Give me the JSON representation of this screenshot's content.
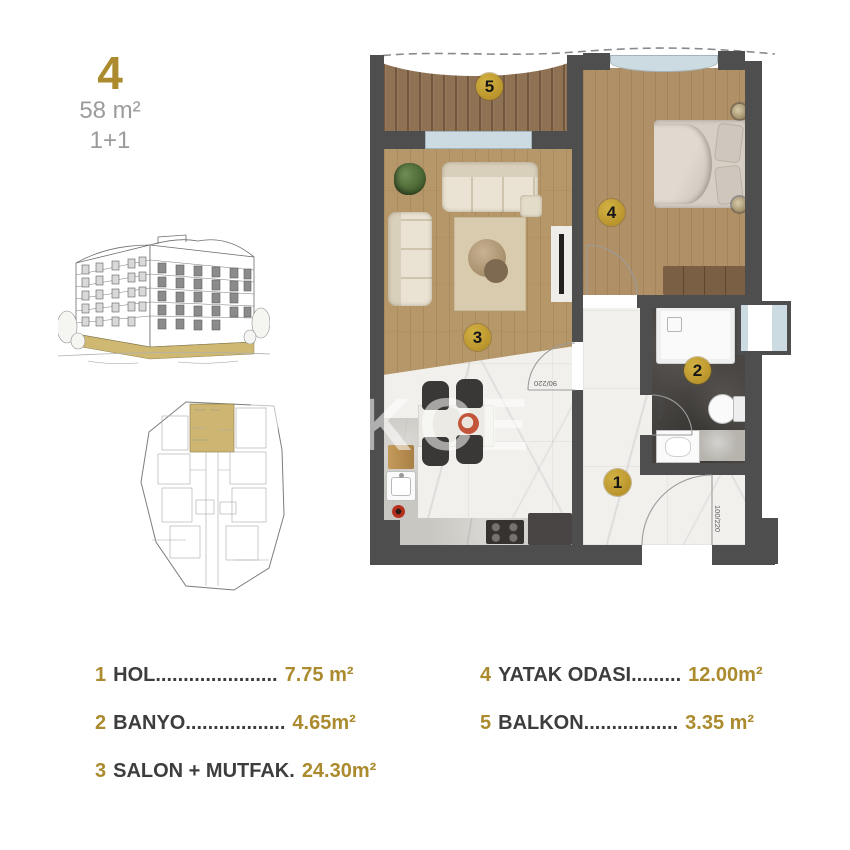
{
  "unit": {
    "number": "4",
    "area": "58 m²",
    "type": "1+1"
  },
  "watermark": "TEKCE",
  "floorplan": {
    "badges": [
      {
        "label": "1"
      },
      {
        "label": "2"
      },
      {
        "label": "3"
      },
      {
        "label": "4"
      },
      {
        "label": "5"
      }
    ],
    "dims": {
      "bedroom_door": "90/220",
      "living_door": "90/220",
      "bathroom_door": "90/220",
      "entrance_door": "100/220"
    }
  },
  "legend": {
    "left": [
      {
        "num": "1",
        "name": "HOL",
        "dots": "......................",
        "value": "7.75 m²"
      },
      {
        "num": "2",
        "name": "BANYO",
        "dots": "..................",
        "value": "4.65m²"
      },
      {
        "num": "3",
        "name": "SALON + MUTFAK",
        "dots": ".",
        "value": "24.30m²"
      }
    ],
    "right": [
      {
        "num": "4",
        "name": "YATAK ODASI",
        "dots": ".........",
        "value": "12.00m²"
      },
      {
        "num": "5",
        "name": "BALKON",
        "dots": ".................",
        "value": "3.35 m²"
      }
    ]
  },
  "colors": {
    "gold": "#ab8b2e",
    "badge": "#c2a02c",
    "wall": "#4e4e4e",
    "window": "#ccdbe1",
    "textdark": "#3d3d3d",
    "textgray": "#9b9b9b"
  }
}
